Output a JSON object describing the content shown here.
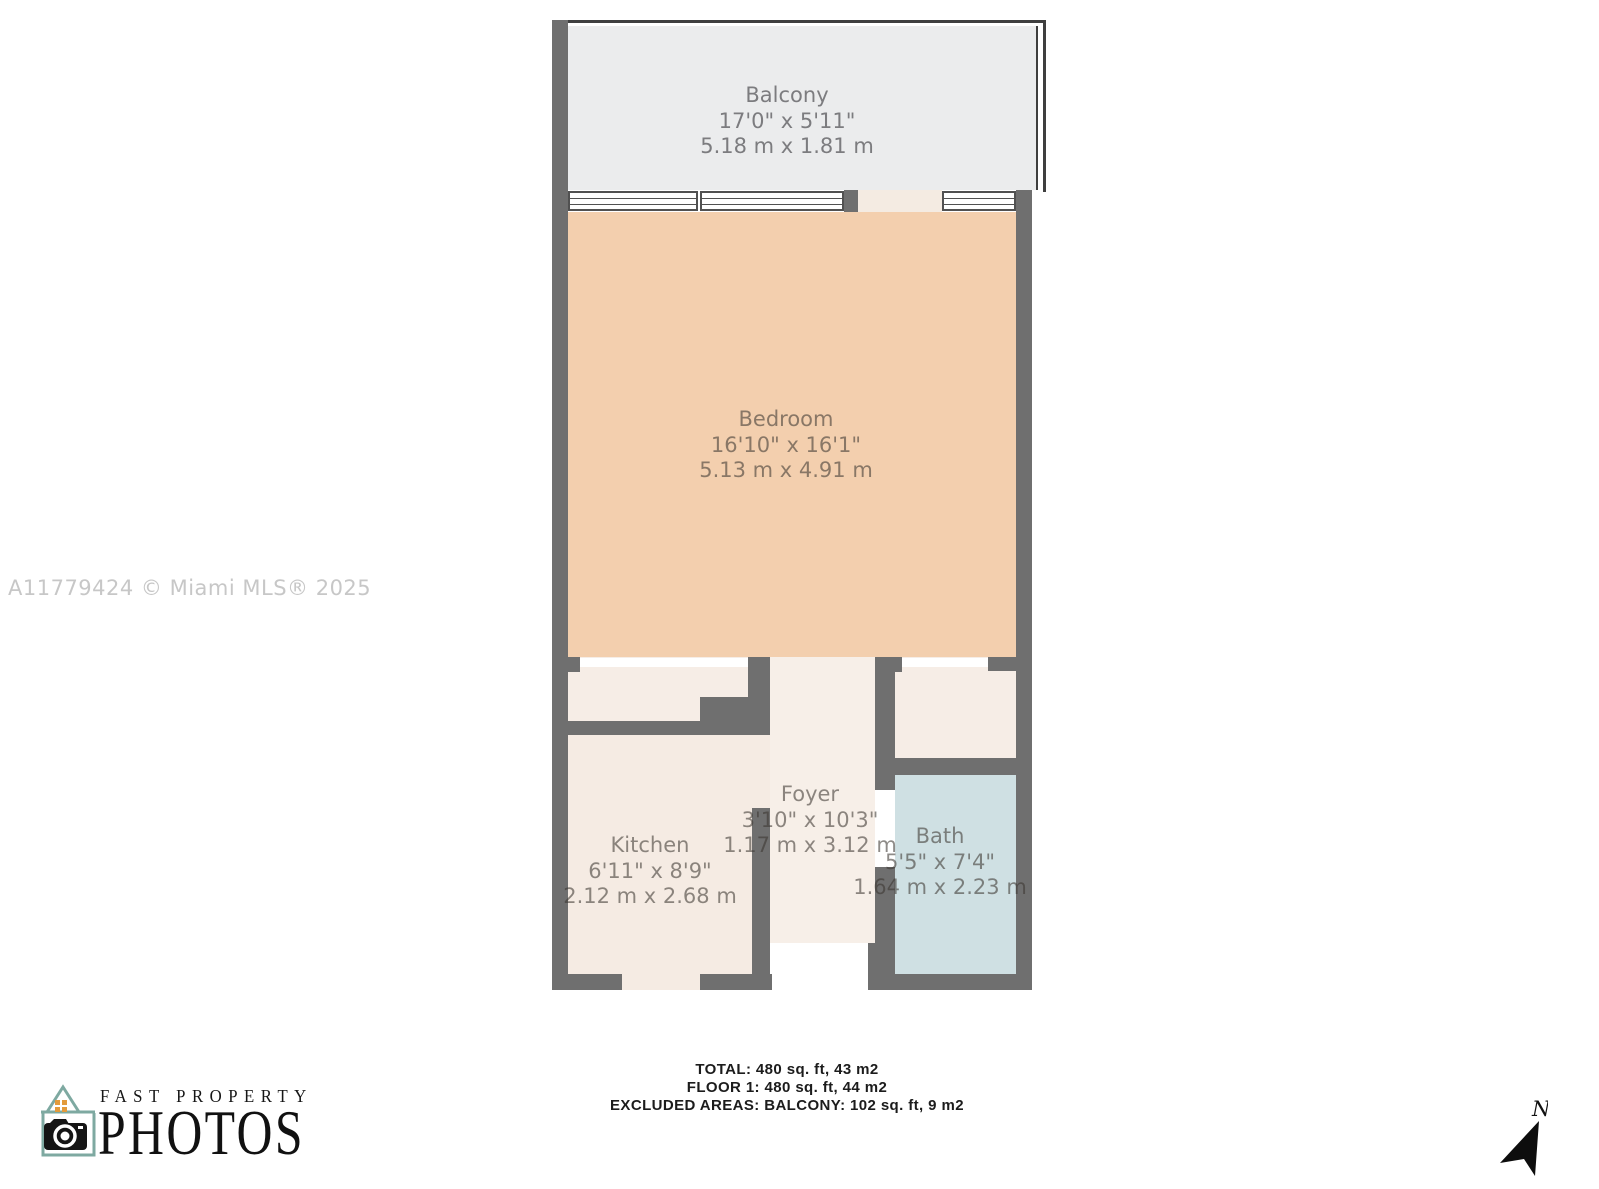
{
  "watermark": "A11779424 © Miami MLS® 2025",
  "rooms": {
    "balcony": {
      "name": "Balcony",
      "imperial": "17'0\" x 5'11\"",
      "metric": "5.18 m x 1.81 m"
    },
    "bedroom": {
      "name": "Bedroom",
      "imperial": "16'10\" x 16'1\"",
      "metric": "5.13 m x 4.91 m"
    },
    "kitchen": {
      "name": "Kitchen",
      "imperial": "6'11\" x 8'9\"",
      "metric": "2.12 m x 2.68 m"
    },
    "foyer": {
      "name": "Foyer",
      "imperial": "3'10\" x 10'3\"",
      "metric": "1.17 m x 3.12 m"
    },
    "bath": {
      "name": "Bath",
      "imperial": "5'5\" x 7'4\"",
      "metric": "1.64 m x 2.23 m"
    }
  },
  "summary": {
    "total": "TOTAL: 480 sq. ft, 43 m2",
    "floor": "FLOOR 1: 480 sq. ft, 44 m2",
    "excluded": "EXCLUDED AREAS: BALCONY: 102 sq. ft, 9 m2"
  },
  "logo": {
    "line1": "FAST PROPERTY",
    "line2": "PHOTOS"
  },
  "compass": {
    "label": "N"
  },
  "colors": {
    "wall": "#6f6f6f",
    "balcony_floor": "#ebeced",
    "bedroom_floor": "#f3cfae",
    "kitchen_floor": "#f5ebe3",
    "foyer_floor": "#f7efe8",
    "closet_floor": "#f6ede6",
    "bath_floor": "#cfe0e3",
    "logo_house": "#7ea9a1",
    "logo_window": "#e39b3c"
  }
}
